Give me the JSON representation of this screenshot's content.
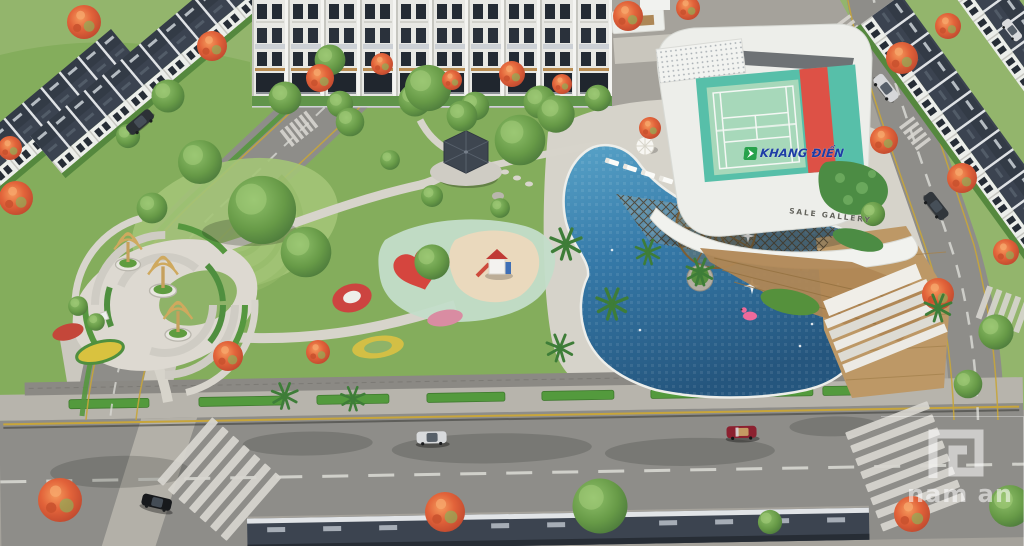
{
  "image": {
    "kind": "3d-architectural-aerial-render",
    "subject": "Residential compound amenity park with swimming pool, rooftop tennis court clubhouse, roads and townhouse rows"
  },
  "signs": {
    "brand_name": "KHANG ĐIỀN",
    "gallery_label": "SALE GALLERY"
  },
  "watermark": {
    "text": "nam an"
  },
  "colors": {
    "brand_blue": "#1d3da5",
    "brand_green": "#27a24b",
    "pool_water": "#35799f",
    "court_green": "#a7d8ba",
    "court_apron_teal": "#57bfa9",
    "court_red": "#dd5146",
    "lawn_green": "#84ad5c",
    "flame_tree_orange": "#d96238",
    "roof_slate": "#3c4450",
    "facade_white": "#edeeea",
    "road_asphalt": "#8e8d89",
    "lane_yellow": "#c7a53b",
    "flamingo_pink": "#ef6a9b",
    "watermark_white": "#ffffff"
  }
}
